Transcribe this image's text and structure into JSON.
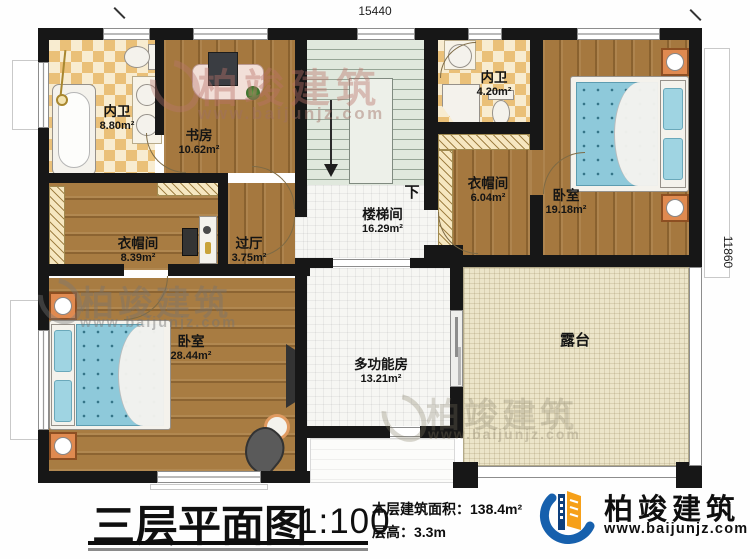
{
  "dimensions": {
    "top": "15440",
    "right": "11860"
  },
  "rooms": [
    {
      "name": "内卫",
      "area": "8.80m²"
    },
    {
      "name": "书房",
      "area": "10.62m²"
    },
    {
      "name": "内卫",
      "area": "4.20m²"
    },
    {
      "name": "衣帽间",
      "area": "6.04m²"
    },
    {
      "name": "卧室",
      "area": "19.18m²"
    },
    {
      "name": "衣帽间",
      "area": "8.39m²"
    },
    {
      "name": "过厅",
      "area": "3.75m²"
    },
    {
      "name": "楼梯间",
      "area": "16.29m²"
    },
    {
      "name": "卧室",
      "area": "28.44m²"
    },
    {
      "name": "多功能房",
      "area": "13.21m²"
    },
    {
      "name": "露台",
      "area": ""
    }
  ],
  "stairs": {
    "down_label": "下"
  },
  "title_block": {
    "title": "三层平面图",
    "scale": "1:100",
    "floor_area": "本层建筑面积：138.4m²",
    "floor_height": "层高：3.3m"
  },
  "brand": {
    "name": "柏竣建筑",
    "website": "www.baijunjz.com"
  },
  "colors": {
    "wall": "#171717",
    "wood": "#a5783f",
    "tile_checker": "#eac078",
    "stair": "#e0e8dd",
    "terrace": "#ece5c9",
    "bed": "#8ec9da",
    "nightstand": "#e08a50",
    "logo_blue": "#1660ad",
    "logo_orange": "#f6a019"
  }
}
